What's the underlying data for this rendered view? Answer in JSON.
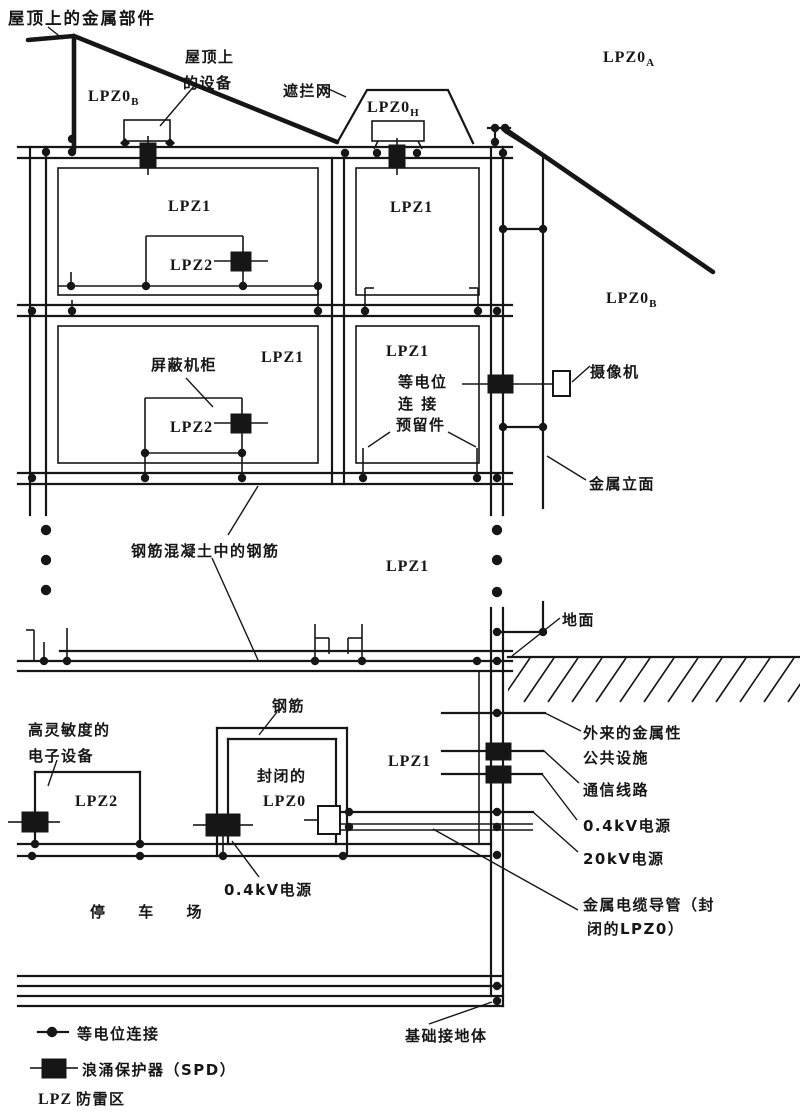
{
  "colors": {
    "ink": "#161616",
    "paper": "#ffffff"
  },
  "labels": {
    "roof_metal": "屋顶上的金属部件",
    "roof_equipment_l1": "屋顶上",
    "roof_equipment_l2": "的设备",
    "shield_net": "遮拦网",
    "lpz0a_main": "LPZ0",
    "lpz0a_sub": "A",
    "lpz0b_left_main": "LPZ0",
    "lpz0b_left_sub": "B",
    "lpz0b_right_main": "LPZ0",
    "lpz0b_right_sub": "B",
    "lpz0h_main": "LPZ0",
    "lpz0h_sub": "H",
    "lpz1_f1_left": "LPZ1",
    "lpz1_f1_right": "LPZ1",
    "lpz2_f1": "LPZ2",
    "shielded_cabinet": "屏蔽机柜",
    "lpz1_f2_left": "LPZ1",
    "lpz1_f2_right": "LPZ1",
    "lpz2_f2": "LPZ2",
    "bonding_reserved_l1": "等电位",
    "bonding_reserved_l2": "连 接",
    "bonding_reserved_l3": "预留件",
    "camera": "摄像机",
    "metal_facade": "金属立面",
    "rebar_in_concrete": "钢筋混凝土中的钢筋",
    "lpz1_mid": "LPZ1",
    "ground": "地面",
    "high_sensitivity_l1": "高灵敏度的",
    "high_sensitivity_l2": "电子设备",
    "rebar": "钢筋",
    "enclosed_l1": "封闭的",
    "enclosed_l2": "LPZ0",
    "lpz1_basement": "LPZ1",
    "lpz2_basement": "LPZ2",
    "external_utility_l1": "外来的金属性",
    "external_utility_l2": "公共设施",
    "comm_line": "通信线路",
    "power_04_right": "0.4kV电源",
    "power_20": "20kV电源",
    "conduit_l1": "金属电缆导管（封",
    "conduit_l2": "闭的LPZ0）",
    "power_04_bottom": "0.4kV电源",
    "parking": "停 车 场",
    "foundation_earth": "基础接地体"
  },
  "legend": {
    "bonding_label": "等电位连接",
    "spd_label": "浪涌保护器（SPD）",
    "lpz_abbr": "LPZ",
    "lpz_label": "防雷区"
  }
}
